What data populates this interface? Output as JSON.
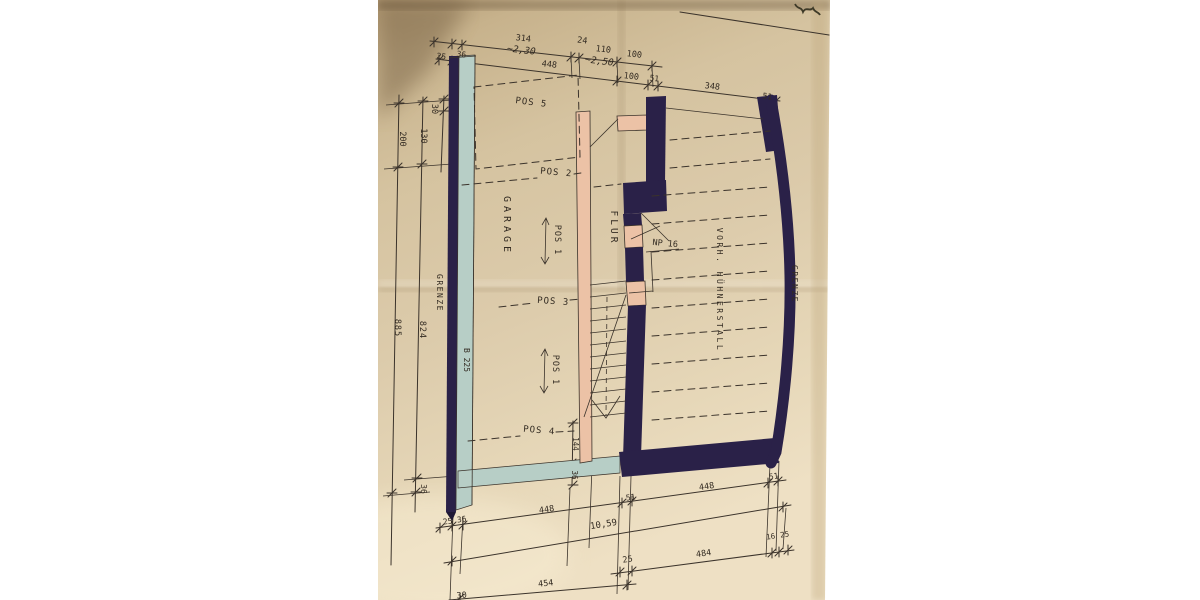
{
  "drawing": {
    "colors": {
      "ink": "#3b332b",
      "ink2": "#332b22",
      "wall-dark": "#2a2148",
      "wall-teal": "#b7cec6",
      "wall-pink": "#ecc2a6",
      "paper-mid": "#d8c7a5"
    },
    "texts": [
      {
        "name": "dim-314",
        "text": "314",
        "x": 523,
        "y": 41,
        "rot": 7,
        "size": 8.5
      },
      {
        "name": "dim-approx-230",
        "text": "~2,30",
        "x": 521,
        "y": 53,
        "rot": 7,
        "size": 9.5,
        "italic": true
      },
      {
        "name": "dim-24",
        "text": "24",
        "x": 582,
        "y": 43,
        "rot": 7,
        "size": 8.5
      },
      {
        "name": "dim-110",
        "text": "110",
        "x": 603,
        "y": 52,
        "rot": 7,
        "size": 8.5
      },
      {
        "name": "dim-approx-250",
        "text": "~2,50",
        "x": 599,
        "y": 64,
        "rot": 7,
        "size": 9.5,
        "italic": true
      },
      {
        "name": "dim-100-top-a",
        "text": "100",
        "x": 634,
        "y": 57,
        "rot": 7,
        "size": 8.5
      },
      {
        "name": "dim-448-top",
        "text": "448",
        "x": 549,
        "y": 67,
        "rot": 7,
        "size": 8.5
      },
      {
        "name": "dim-100-top-b",
        "text": "100",
        "x": 631,
        "y": 79,
        "rot": 7,
        "size": 8.5
      },
      {
        "name": "dim-51-top-a",
        "text": "51",
        "x": 654,
        "y": 81,
        "rot": 7,
        "size": 8
      },
      {
        "name": "dim-348-top",
        "text": "348",
        "x": 712,
        "y": 89,
        "rot": 7,
        "size": 8.5
      },
      {
        "name": "dim-51-top-b",
        "text": "51",
        "x": 767,
        "y": 99,
        "rot": 7,
        "size": 8
      },
      {
        "name": "dim-25-topleft",
        "text": "25",
        "x": 441,
        "y": 59,
        "rot": 7,
        "size": 8
      },
      {
        "name": "dim-36-topleft",
        "text": "36",
        "x": 461,
        "y": 57,
        "rot": 7,
        "size": 8
      },
      {
        "name": "dim-30-left",
        "text": "30",
        "x": 432,
        "y": 109,
        "rot": 90,
        "size": 8.5
      },
      {
        "name": "dim-130-left",
        "text": "130",
        "x": 421,
        "y": 136,
        "rot": 90,
        "size": 8.5
      },
      {
        "name": "dim-200-left",
        "text": "200",
        "x": 400,
        "y": 139,
        "rot": 90,
        "size": 8.5
      },
      {
        "name": "label-grenze-left",
        "text": "GRENZE",
        "x": 437,
        "y": 293,
        "rot": 90,
        "size": 8,
        "ls": 1.5
      },
      {
        "name": "dim-885-left",
        "text": "885",
        "x": 395,
        "y": 328,
        "rot": 90,
        "size": 8.5,
        "ls": 1
      },
      {
        "name": "dim-824-left",
        "text": "824",
        "x": 420,
        "y": 330,
        "rot": 90,
        "size": 8.5,
        "ls": 1
      },
      {
        "name": "label-b225",
        "text": "B 225",
        "x": 464,
        "y": 360,
        "rot": 90,
        "size": 8
      },
      {
        "name": "dim-36-left-bottom",
        "text": "36",
        "x": 421,
        "y": 489,
        "rot": 90,
        "size": 8
      },
      {
        "name": "label-pos5",
        "text": "POS 5",
        "x": 531,
        "y": 105,
        "rot": 7,
        "size": 9,
        "ls": 1
      },
      {
        "name": "label-pos2",
        "text": "POS 2",
        "x": 556,
        "y": 175,
        "rot": 5,
        "size": 9,
        "ls": 1
      },
      {
        "name": "label-garage",
        "text": "GARAGE",
        "x": 504,
        "y": 226,
        "rot": 90,
        "size": 10,
        "ls": 4
      },
      {
        "name": "label-pos1-upper",
        "text": "POS 1",
        "x": 555,
        "y": 240,
        "rot": 90,
        "size": 8.5,
        "ls": 1
      },
      {
        "name": "label-flur",
        "text": "FLUR",
        "x": 611,
        "y": 228,
        "rot": 90,
        "size": 9.5,
        "ls": 3
      },
      {
        "name": "label-np16",
        "text": "NP 16",
        "x": 665,
        "y": 246,
        "rot": 5,
        "size": 8.5
      },
      {
        "name": "label-huehnerstall",
        "text": "VORH. HÜHNERSTALL",
        "x": 717,
        "y": 290,
        "rot": 90,
        "size": 8,
        "ls": 2.5
      },
      {
        "name": "label-grenze-right",
        "text": "GRENZE",
        "x": 792,
        "y": 284,
        "rot": 90,
        "size": 8,
        "ls": 1.5
      },
      {
        "name": "label-pos3",
        "text": "POS 3",
        "x": 553,
        "y": 304,
        "rot": 4,
        "size": 9,
        "ls": 1
      },
      {
        "name": "label-pos1-lower",
        "text": "POS 1",
        "x": 553,
        "y": 370,
        "rot": 90,
        "size": 8.5,
        "ls": 1
      },
      {
        "name": "label-pos4",
        "text": "POS 4",
        "x": 539,
        "y": 433,
        "rot": 5,
        "size": 9,
        "ls": 1
      },
      {
        "name": "dim-144-stair",
        "text": "144",
        "x": 573,
        "y": 444,
        "rot": 90,
        "size": 7.5
      },
      {
        "name": "dim-36-stair",
        "text": "36",
        "x": 572,
        "y": 475,
        "rot": 90,
        "size": 7.5
      },
      {
        "name": "dim-448-bottom-left",
        "text": "448",
        "x": 547,
        "y": 512,
        "rot": -8,
        "size": 8.5
      },
      {
        "name": "dim-51-bottom-center",
        "text": "51",
        "x": 631,
        "y": 500,
        "rot": -8,
        "size": 8
      },
      {
        "name": "dim-448-bottom-right",
        "text": "448",
        "x": 707,
        "y": 489,
        "rot": -8,
        "size": 8.5
      },
      {
        "name": "dim-51-bottom-right",
        "text": "51",
        "x": 774,
        "y": 479,
        "rot": -8,
        "size": 8
      },
      {
        "name": "dim-25-bottom-left",
        "text": "25",
        "x": 448,
        "y": 524,
        "rot": -8,
        "size": 8
      },
      {
        "name": "dim-36-bottom-left",
        "text": "36",
        "x": 462,
        "y": 522,
        "rot": -8,
        "size": 8
      },
      {
        "name": "dim-1059",
        "text": "10,59",
        "x": 604,
        "y": 527,
        "rot": -9,
        "size": 9
      },
      {
        "name": "dim-25-row-e",
        "text": "25",
        "x": 628,
        "y": 562,
        "rot": -8,
        "size": 8.5
      },
      {
        "name": "dim-484",
        "text": "484",
        "x": 704,
        "y": 556,
        "rot": -8,
        "size": 8.5
      },
      {
        "name": "dim-16-bottom-right",
        "text": "16",
        "x": 771,
        "y": 539,
        "rot": -8,
        "size": 7.5
      },
      {
        "name": "dim-25-bottom-right",
        "text": "25",
        "x": 785,
        "y": 537,
        "rot": -8,
        "size": 7.5
      },
      {
        "name": "dim-454",
        "text": "454",
        "x": 546,
        "y": 586,
        "rot": -6,
        "size": 8.5
      },
      {
        "name": "dim-30-bottom",
        "text": "30",
        "x": 462,
        "y": 598,
        "rot": -6,
        "size": 8.5
      }
    ]
  }
}
